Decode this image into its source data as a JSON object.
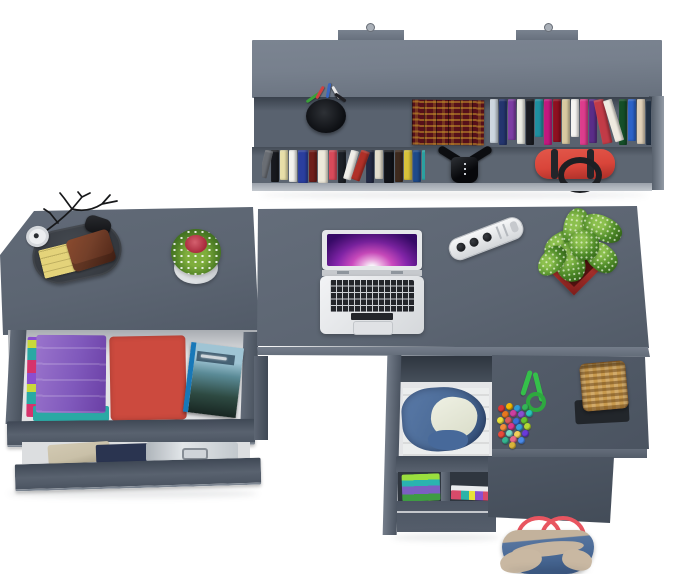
{
  "scene": {
    "kind": "3d-render-top-view-of-gray-office-furniture",
    "background": "#FFFFFF"
  },
  "palette": {
    "white-bg": "#FFFFFF",
    "gray-top": "#77808D",
    "gray-surface": "#5C6572",
    "gray-surface-dark": "#4A5360",
    "gray-recess": "#59626F",
    "gray-shadow": "#39414C",
    "maroon-books": "#56101A",
    "gold": "#C9972C",
    "black-obj": "#0C0D10",
    "red-duffel": "#D9453A",
    "notepad-yellow": "#E4D37A",
    "wallet-brown": "#74402A",
    "green-cactus": "#4F7F26",
    "red-crown": "#A8293C",
    "purple-cloth": "#8059BC",
    "red-cloth": "#CC4A3E",
    "teal-cloth": "#2AA9A4",
    "khaki-cloth": "#C9C0A8",
    "navy-cloth": "#2A3450",
    "bluray-blue": "#1878B8",
    "red-pot": "#B03530",
    "green-plant": "#4E8A28",
    "denim": "#4A6A96",
    "bag-trim": "#C3B29C",
    "handle-red": "#E85560",
    "cord-green": "#35C04A",
    "basket-tan": "#C89A4E"
  },
  "objects": [
    "wall-shelf",
    "mounting-tabs",
    "pencil-cup",
    "ornate-book-set",
    "book-row-top",
    "book-row-bottom",
    "black-headset",
    "red-duffel-bag",
    "left-dresser",
    "decorative-twigs",
    "wristwatch",
    "black-camera",
    "oval-tray",
    "yellow-notepad",
    "brown-wallet",
    "barrel-cactus-in-white-pot",
    "open-drawer-with-clothes",
    "blu-ray-case",
    "second-drawer-khaki-jeans-suitcase",
    "desk",
    "open-laptop",
    "white-portable-speaker",
    "green-plant-in-red-pot",
    "under-desk-drawer-unit",
    "denim-garment-in-drawer",
    "lower-compartment-clothes",
    "right-cabinet",
    "pompom-bead-cord",
    "wicker-basket-on-black-mat",
    "denim-tote-bag-with-red-handles"
  ],
  "shelf_unit": {
    "row1_books": [
      {
        "c": "#CDD6DF",
        "h": 44
      },
      {
        "c": "#24356E",
        "h": 46
      },
      {
        "c": "#7C3DA2",
        "h": 41
      },
      {
        "c": "#ECECE4",
        "h": 45
      },
      {
        "c": "#1A1C22",
        "h": 46
      },
      {
        "c": "#1F8FA0",
        "h": 38
      },
      {
        "c": "#C2187E",
        "h": 46
      },
      {
        "c": "#8F1020",
        "h": 43
      },
      {
        "c": "#D8C9A0",
        "h": 45
      },
      {
        "c": "#F5F5F2",
        "h": 38
      },
      {
        "c": "#DD3C8C",
        "h": 46
      },
      {
        "c": "#5A2D88",
        "h": 44
      },
      {
        "c": "#C23B47",
        "h": 45,
        "w": 10,
        "r": -12
      },
      {
        "c": "#EFEAE0",
        "h": 43,
        "w": 9,
        "r": -17
      },
      {
        "c": "#154F28",
        "h": 46
      },
      {
        "c": "#2C62C8",
        "h": 42
      },
      {
        "c": "#E0D0B8",
        "h": 45
      },
      {
        "c": "#223042",
        "h": 46
      }
    ],
    "row2_books": [
      {
        "c": "#6A6E74",
        "h": 28,
        "r": 14
      },
      {
        "c": "#17191E",
        "h": 32
      },
      {
        "c": "#E8DFA8",
        "h": 30
      },
      {
        "c": "#F2F2EE",
        "h": 32
      },
      {
        "c": "#2A3E9E",
        "h": 33,
        "w": 10
      },
      {
        "c": "#6E1E1A",
        "h": 32
      },
      {
        "c": "#EDE8DA",
        "h": 33,
        "w": 10
      },
      {
        "c": "#D84A5A",
        "h": 30
      },
      {
        "c": "#1C2026",
        "h": 33
      },
      {
        "c": "#F0EEE8",
        "h": 30,
        "r": 16
      },
      {
        "c": "#B03028",
        "h": 31,
        "r": 20,
        "w": 9
      },
      {
        "c": "#232A44",
        "h": 33
      },
      {
        "c": "#E2DCCC",
        "h": 29
      },
      {
        "c": "#111318",
        "h": 33,
        "w": 10
      },
      {
        "c": "#3E2A1E",
        "h": 32
      },
      {
        "c": "#D8C23A",
        "h": 30
      },
      {
        "c": "#1E4A8A",
        "h": 32
      },
      {
        "c": "#2AA0A0",
        "h": 30
      }
    ],
    "pens": [
      {
        "c": "#3AA03A",
        "x": 2,
        "y": 8,
        "w": 16,
        "h": 3,
        "r": -35
      },
      {
        "c": "#D04040",
        "x": 10,
        "y": 3,
        "w": 14,
        "h": 3,
        "r": -60
      },
      {
        "c": "#3A66C0",
        "x": 18,
        "y": 1,
        "w": 15,
        "h": 3,
        "r": -80
      },
      {
        "c": "#E8E8E8",
        "x": 26,
        "y": 3,
        "w": 14,
        "h": 3,
        "r": 60
      },
      {
        "c": "#202024",
        "x": 31,
        "y": 8,
        "w": 13,
        "h": 3,
        "r": 35
      }
    ]
  },
  "right_cabinet": {
    "beads": [
      {
        "c": "#D93636",
        "x": 1,
        "y": 2
      },
      {
        "c": "#F2B705",
        "x": 9,
        "y": 0
      },
      {
        "c": "#2E9BD6",
        "x": 17,
        "y": 2
      },
      {
        "c": "#35B558",
        "x": 25,
        "y": 1
      },
      {
        "c": "#E8761F",
        "x": 5,
        "y": 8
      },
      {
        "c": "#CC3FA0",
        "x": 13,
        "y": 7
      },
      {
        "c": "#8A4FD0",
        "x": 21,
        "y": 8
      },
      {
        "c": "#2AC4B8",
        "x": 29,
        "y": 7
      },
      {
        "c": "#E8E13A",
        "x": 0,
        "y": 14
      },
      {
        "c": "#D95A5A",
        "x": 8,
        "y": 14
      },
      {
        "c": "#3A6ED9",
        "x": 16,
        "y": 15
      },
      {
        "c": "#69C42F",
        "x": 24,
        "y": 14
      },
      {
        "c": "#F28C3A",
        "x": 3,
        "y": 21
      },
      {
        "c": "#D93690",
        "x": 11,
        "y": 20
      },
      {
        "c": "#36A0D9",
        "x": 19,
        "y": 21
      },
      {
        "c": "#B5D935",
        "x": 27,
        "y": 20
      },
      {
        "c": "#E84A3A",
        "x": 1,
        "y": 28
      },
      {
        "c": "#7AD9C4",
        "x": 9,
        "y": 27
      },
      {
        "c": "#F2D05A",
        "x": 17,
        "y": 28
      },
      {
        "c": "#6A3AD9",
        "x": 25,
        "y": 27
      },
      {
        "c": "#35B590",
        "x": 5,
        "y": 34
      },
      {
        "c": "#E86A8A",
        "x": 13,
        "y": 33
      },
      {
        "c": "#4A8AE8",
        "x": 21,
        "y": 34
      },
      {
        "c": "#D9B53A",
        "x": 12,
        "y": 39
      }
    ]
  }
}
